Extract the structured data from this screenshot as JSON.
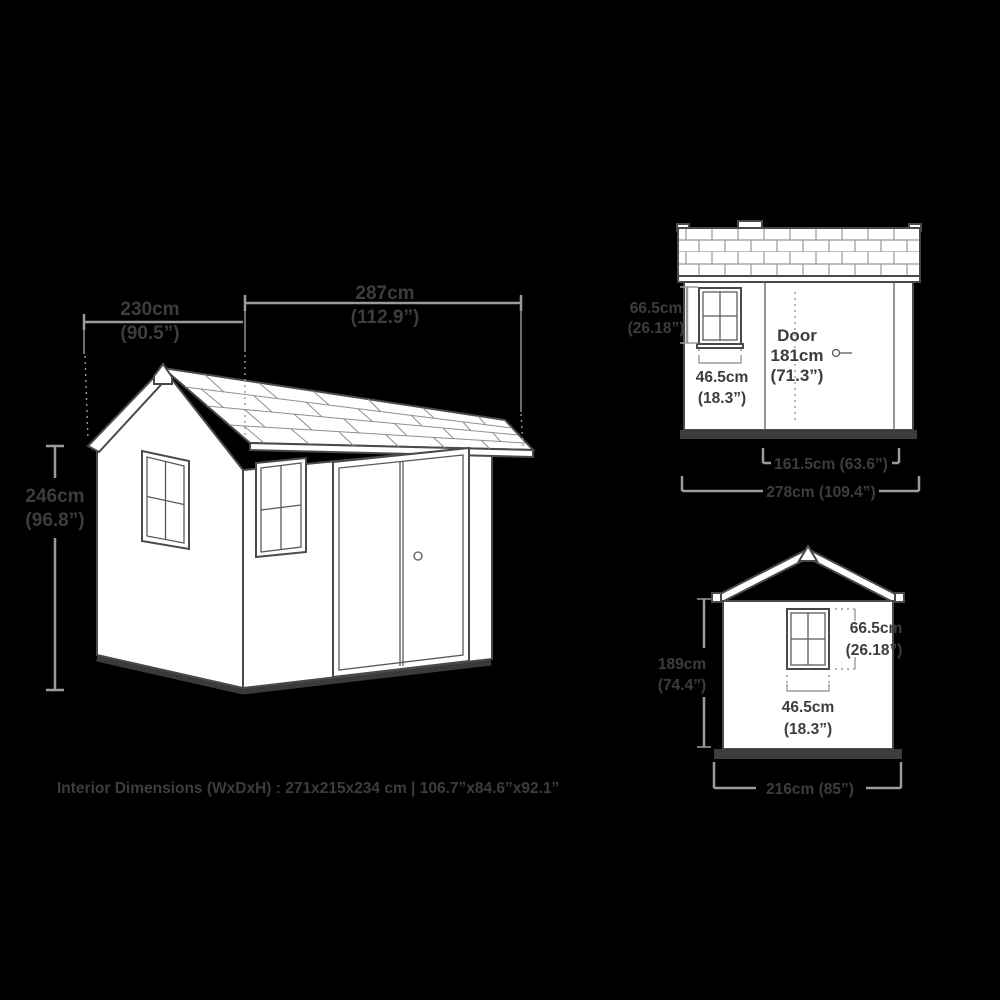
{
  "title": "Shed dimensions diagram",
  "colors": {
    "outline": "#4a4a4a",
    "dimension_lines": "#9b9b9b",
    "text": "#3d3d3d",
    "fill": "#ffffff",
    "background": "#000000"
  },
  "iso_view": {
    "width_cm": "287cm",
    "width_in": "(112.9”)",
    "depth_cm": "230cm",
    "depth_in": "(90.5”)",
    "height_cm": "246cm",
    "height_in": "(96.8”)"
  },
  "front_view": {
    "door_title": "Door",
    "door_height_cm": "181cm",
    "door_height_in": "(71.3”)",
    "window_width_cm": "46.5cm",
    "window_width_in": "(18.3”)",
    "window_height_cm": "66.5cm",
    "window_height_in": "(26.18”)",
    "door_width": "161.5cm (63.6”)",
    "overall_width": "278cm (109.4”)"
  },
  "side_view": {
    "window_height_cm": "66.5cm",
    "window_height_in": "(26.18”)",
    "window_width_cm": "46.5cm",
    "window_width_in": "(18.3”)",
    "wall_height_cm": "189cm",
    "wall_height_in": "(74.4”)",
    "overall_width": "216cm (85”)"
  },
  "footer": {
    "interior_dimensions": "Interior Dimensions (WxDxH) : 271x215x234 cm | 106.7”x84.6”x92.1”"
  }
}
